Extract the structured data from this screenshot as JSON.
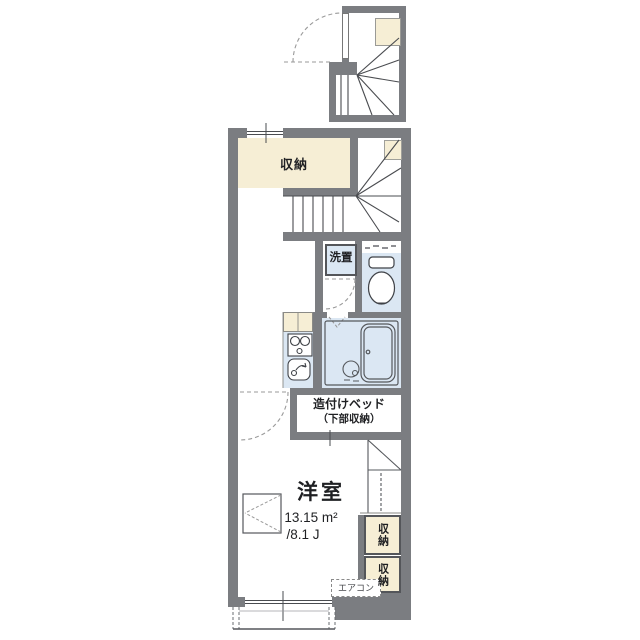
{
  "colors": {
    "wall": "#7b7d81",
    "beige": "#f6eed5",
    "blue": "#dbe7f3",
    "line": "#44474c",
    "dash": "#9a9a9a",
    "text": "#1f2023"
  },
  "labels": {
    "storage_top": "収納",
    "laundry": "洗置",
    "bed_line1": "造付けベッド",
    "bed_line2": "（下部収納）",
    "room": "洋室",
    "area_m2": "13.15 m²",
    "area_jo": "/8.1 J",
    "closet_upper": "収納",
    "closet_lower": "収納",
    "aircon": "エアコン"
  }
}
